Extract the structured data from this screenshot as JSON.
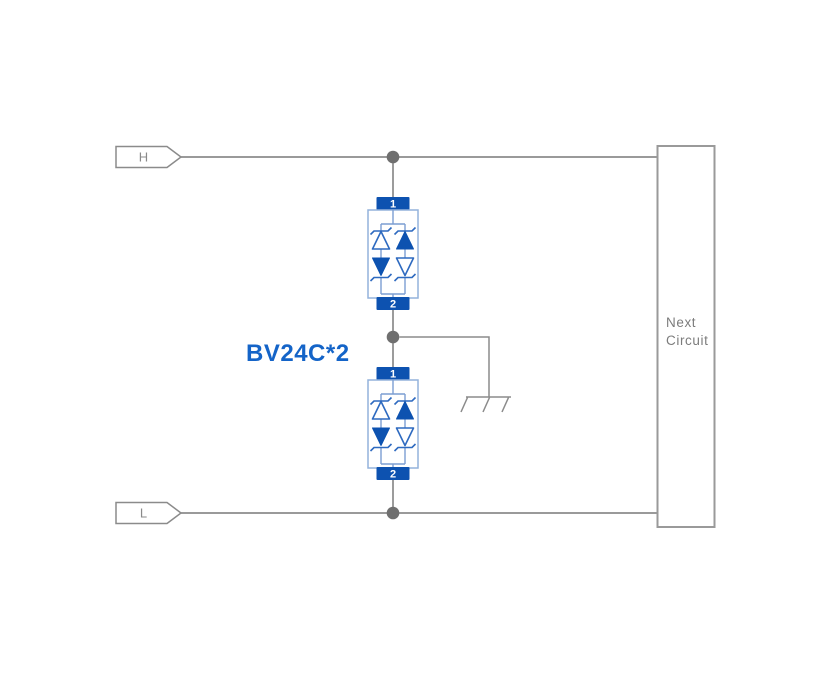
{
  "colors": {
    "wire": "#8b8b8b",
    "dot": "#6f6f6f",
    "terminal-blue": "#0d52b0",
    "diode-stroke": "#2e6ac0",
    "box-stroke": "#93b2dc",
    "inner-wire": "#7c9ed2",
    "port-text": "#8a8a8a",
    "next-text": "#7c7c7c",
    "part-blue": "#1464c8",
    "border-gray": "#9a9a9a"
  },
  "ports": {
    "top": {
      "label": "H"
    },
    "bottom": {
      "label": "L"
    }
  },
  "component": {
    "part_number": "BV24C*2",
    "blocks": [
      {
        "pin_top": "1",
        "pin_bottom": "2"
      },
      {
        "pin_top": "1",
        "pin_bottom": "2"
      }
    ]
  },
  "next_circuit": {
    "line1": "Next",
    "line2": "Circuit"
  },
  "icons": {
    "ground": "chassis-ground-icon",
    "junction": "junction-dot",
    "diodes": [
      "zener-up-outline",
      "zener-up-filled",
      "zener-down-filled",
      "zener-down-outline"
    ]
  }
}
